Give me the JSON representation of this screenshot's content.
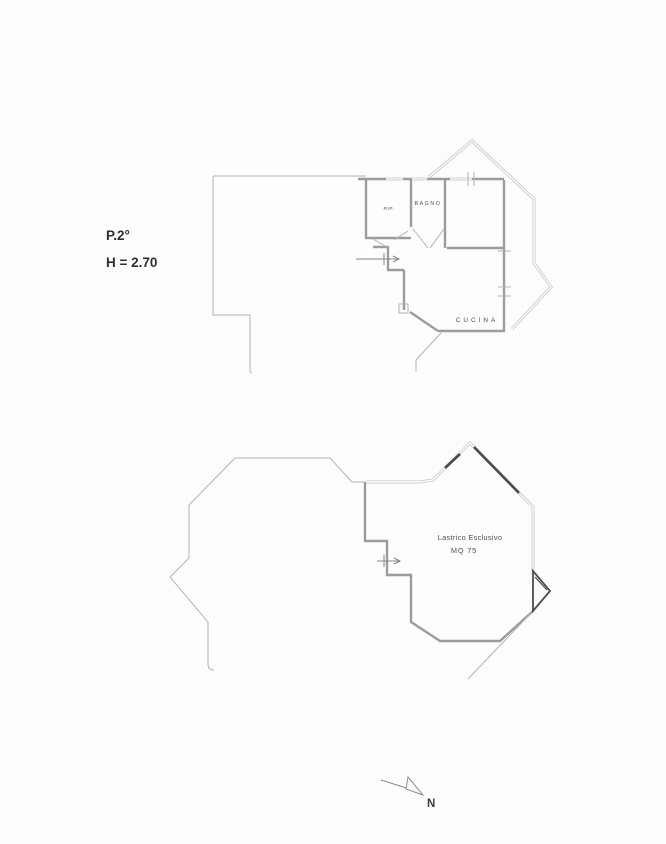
{
  "page": {
    "background": "#fdfdfd"
  },
  "header": {
    "floor_label": "P.2°",
    "height_label": "H = 2.70"
  },
  "upper_plan": {
    "rooms": [
      {
        "id": "rip",
        "label": "RIP."
      },
      {
        "id": "bagno",
        "label": "BAGNO"
      },
      {
        "id": "cucina",
        "label": "CUCINA"
      }
    ]
  },
  "lower_plan": {
    "area_label": "Lastrico Esclusivo",
    "area_size": "MQ 75"
  },
  "compass": {
    "north_label": "N"
  },
  "colors": {
    "wall_gray": "#9c9c9c",
    "outline_gray": "#b3b3b3",
    "hatch_dark": "#4c4c4c",
    "text_dark": "#2f2f2f"
  }
}
